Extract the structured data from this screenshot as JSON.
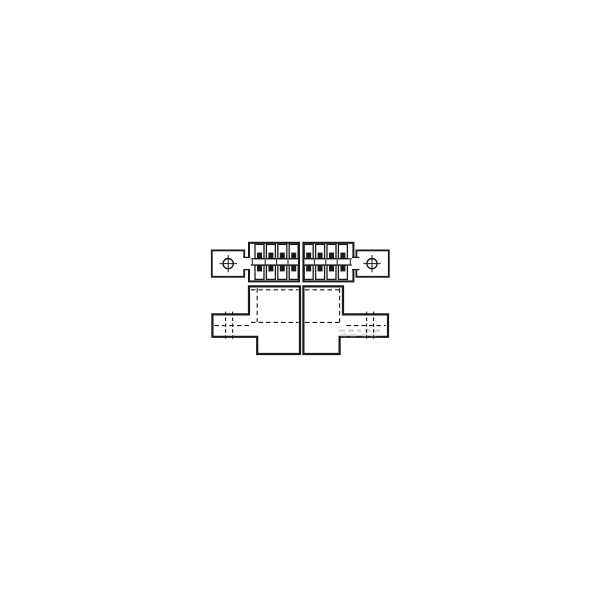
{
  "meta": {
    "app": "technical-drawing",
    "title": "Engineering line drawing of a two-piece electrical connector: top view with two staggered halves of dual-row contacts and mounting lugs with crosshair holes, front view of housing halves with side mounting tabs and dashed hidden lines",
    "background_color": "#ffffff",
    "line_color": "#1a1a1a",
    "fill_color": "#ffffff",
    "faint_mark_color": "#d8d8d8"
  },
  "views": {
    "top_view": {
      "label": "top-view",
      "halves": 2,
      "contact_rows_per_half": 2,
      "contact_columns_per_half": 4,
      "mounting_lugs": 2,
      "lug_hole_style": "circle-with-crosshair"
    },
    "front_view": {
      "label": "front-view",
      "halves": 2,
      "side_mounting_tabs": 2,
      "hidden_line_style": "dashed"
    }
  },
  "drawing": {
    "canvas": {
      "width": 600,
      "height": 600
    },
    "primitives": [
      {
        "name": "front-left-body-outline",
        "type": "path",
        "d": "M249,286.4 L300,286.4 L300,354 L257.2,354 L257.2,336.8 L212.4,336.8 L212.4,314.4 L249,314.4 Z",
        "sw": 2.2,
        "fill": "#ffffff"
      },
      {
        "name": "front-right-body-outline",
        "type": "path",
        "d": "M303.4,286.4 L343,286.4 L343,314.4 L388,314.4 L388,336.8 L339.6,336.8 L339.6,354 L303.4,354 Z",
        "sw": 2.2,
        "fill": "#ffffff"
      },
      {
        "name": "faint-watermark-mark-1",
        "type": "line",
        "x1": 339,
        "y1": 330.6,
        "x2": 361,
        "y2": 330.6,
        "sw": 2.6,
        "stroke": "#d8d8d8",
        "dash": "6 3"
      },
      {
        "name": "faint-watermark-mark-2",
        "type": "line",
        "x1": 365,
        "y1": 330.6,
        "x2": 381.6,
        "y2": 330.6,
        "sw": 2.6,
        "stroke": "#d8d8d8",
        "dash": "6 3"
      },
      {
        "name": "faint-watermark-mark-3",
        "type": "line",
        "x1": 341,
        "y1": 335,
        "x2": 357.6,
        "y2": 335,
        "sw": 2.6,
        "stroke": "#d8d8d8",
        "dash": "6 3"
      },
      {
        "name": "faint-watermark-mark-4",
        "type": "line",
        "x1": 361.6,
        "y1": 335,
        "x2": 379.6,
        "y2": 335,
        "sw": 2.6,
        "stroke": "#d8d8d8",
        "dash": "6 3"
      },
      {
        "name": "front-hidden-top-line-left",
        "type": "line",
        "x1": 251,
        "y1": 289.8,
        "x2": 298.4,
        "y2": 289.8,
        "sw": 1.1,
        "dash": "4.5 3"
      },
      {
        "name": "front-hidden-top-line-right",
        "type": "line",
        "x1": 305,
        "y1": 289.8,
        "x2": 341.4,
        "y2": 289.8,
        "sw": 1.1,
        "dash": "4.5 3"
      },
      {
        "name": "front-hidden-mid-line-left",
        "type": "line",
        "x1": 251,
        "y1": 322.4,
        "x2": 298.4,
        "y2": 322.4,
        "sw": 1.1,
        "dash": "4.5 3"
      },
      {
        "name": "front-hidden-mid-line-right",
        "type": "line",
        "x1": 305,
        "y1": 322.4,
        "x2": 341.4,
        "y2": 322.4,
        "sw": 1.1,
        "dash": "4.5 3"
      },
      {
        "name": "front-hidden-vertical-left",
        "type": "line",
        "x1": 257.2,
        "y1": 288.2,
        "x2": 257.2,
        "y2": 322,
        "sw": 1.1,
        "dash": "4.5 3"
      },
      {
        "name": "front-hidden-vertical-right",
        "type": "line",
        "x1": 339.6,
        "y1": 288.2,
        "x2": 339.6,
        "y2": 322,
        "sw": 1.1,
        "dash": "4.5 3"
      },
      {
        "name": "front-left-tab-hole-hidden-edge-1",
        "type": "line",
        "x1": 225.6,
        "y1": 311.6,
        "x2": 225.6,
        "y2": 340,
        "sw": 1.1,
        "dash": "3.5 2.4"
      },
      {
        "name": "front-left-tab-hole-hidden-edge-2",
        "type": "line",
        "x1": 232.6,
        "y1": 311.6,
        "x2": 232.6,
        "y2": 340,
        "sw": 1.1,
        "dash": "3.5 2.4"
      },
      {
        "name": "front-left-tab-centerline",
        "type": "line",
        "x1": 214.4,
        "y1": 325.6,
        "x2": 251.6,
        "y2": 325.6,
        "sw": 1.1,
        "dash": "4.5 3"
      },
      {
        "name": "front-right-tab-hole-hidden-edge-1",
        "type": "line",
        "x1": 366.6,
        "y1": 311.6,
        "x2": 366.6,
        "y2": 340,
        "sw": 1.1,
        "dash": "3.5 2.4"
      },
      {
        "name": "front-right-tab-hole-hidden-edge-2",
        "type": "line",
        "x1": 373.6,
        "y1": 311.6,
        "x2": 373.6,
        "y2": 340,
        "sw": 1.1,
        "dash": "3.5 2.4"
      },
      {
        "name": "front-right-tab-centerline",
        "type": "line",
        "x1": 346.4,
        "y1": 325.6,
        "x2": 385.6,
        "y2": 325.6,
        "sw": 1.1,
        "dash": "4.5 3"
      },
      {
        "name": "top-left-mounting-lug",
        "type": "rect",
        "x": 211.8,
        "y": 250.4,
        "w": 32.4,
        "h": 26.4,
        "sw": 1.8,
        "fill": "#ffffff"
      },
      {
        "name": "top-right-mounting-lug",
        "type": "rect",
        "x": 356.4,
        "y": 250.4,
        "w": 32.4,
        "h": 26.4,
        "sw": 1.8,
        "fill": "#ffffff"
      },
      {
        "name": "top-left-contact-block",
        "type": "rect",
        "x": 249,
        "y": 242.8,
        "w": 50,
        "h": 38.6,
        "sw": 2,
        "fill": "#ffffff"
      },
      {
        "name": "top-right-contact-block",
        "type": "rect",
        "x": 303.4,
        "y": 242.8,
        "w": 50,
        "h": 38.6,
        "sw": 2,
        "fill": "#ffffff"
      },
      {
        "name": "top-left-neck-fill",
        "type": "rect",
        "x": 243,
        "y": 258,
        "w": 7.6,
        "h": 11,
        "sw": 0,
        "stroke": "none",
        "fill": "#ffffff"
      },
      {
        "name": "top-left-neck-top-edge",
        "type": "line",
        "x1": 243.4,
        "y1": 257.4,
        "x2": 250.2,
        "y2": 257.4,
        "sw": 1.3
      },
      {
        "name": "top-left-neck-bottom-edge",
        "type": "line",
        "x1": 243.4,
        "y1": 269.6,
        "x2": 250.2,
        "y2": 269.6,
        "sw": 1.3
      },
      {
        "name": "top-right-neck-fill",
        "type": "rect",
        "x": 352.2,
        "y": 258,
        "w": 7.6,
        "h": 11,
        "sw": 0,
        "stroke": "none",
        "fill": "#ffffff"
      },
      {
        "name": "top-right-neck-top-edge",
        "type": "line",
        "x1": 352,
        "y1": 257.4,
        "x2": 359.4,
        "y2": 257.4,
        "sw": 1.3
      },
      {
        "name": "top-right-neck-bottom-edge",
        "type": "line",
        "x1": 352,
        "y1": 269.6,
        "x2": 359.4,
        "y2": 269.6,
        "sw": 1.3
      },
      {
        "name": "top-left-lug-hole",
        "type": "circle",
        "cx": 228.2,
        "cy": 263.6,
        "r": 5.1,
        "sw": 1.4,
        "fill": "#ffffff"
      },
      {
        "name": "top-left-lug-crosshair-h",
        "type": "line",
        "x1": 219.5,
        "y1": 263.6,
        "x2": 237,
        "y2": 263.6,
        "sw": 1
      },
      {
        "name": "top-left-lug-crosshair-v",
        "type": "line",
        "x1": 228.2,
        "y1": 255,
        "x2": 228.2,
        "y2": 272.2,
        "sw": 1
      },
      {
        "name": "top-right-lug-hole",
        "type": "circle",
        "cx": 372,
        "cy": 263.6,
        "r": 5.1,
        "sw": 1.4,
        "fill": "#ffffff"
      },
      {
        "name": "top-right-lug-crosshair-h",
        "type": "line",
        "x1": 363.3,
        "y1": 263.6,
        "x2": 380.7,
        "y2": 263.6,
        "sw": 1
      },
      {
        "name": "top-right-lug-crosshair-v",
        "type": "line",
        "x1": 372,
        "y1": 255,
        "x2": 372,
        "y2": 272.2,
        "sw": 1
      },
      {
        "name": "top-left-mating-channel-upper",
        "type": "line",
        "x1": 250.6,
        "y1": 258.8,
        "x2": 297.6,
        "y2": 258.8,
        "sw": 1.2
      },
      {
        "name": "top-left-mating-channel-lower",
        "type": "line",
        "x1": 250.6,
        "y1": 265,
        "x2": 297.6,
        "y2": 265,
        "sw": 1.2
      },
      {
        "name": "top-right-mating-channel-upper",
        "type": "line",
        "x1": 304.8,
        "y1": 258.8,
        "x2": 351.8,
        "y2": 258.8,
        "sw": 1.2
      },
      {
        "name": "top-right-mating-channel-lower",
        "type": "line",
        "x1": 304.8,
        "y1": 265,
        "x2": 351.8,
        "y2": 265,
        "sw": 1.2
      },
      {
        "name": "contact-cavity",
        "type": "rect",
        "x": 255,
        "y": 244.4,
        "w": 9,
        "h": 14.2,
        "sw": 1.3,
        "fill": "#ffffff"
      },
      {
        "name": "contact-cavity",
        "type": "rect",
        "x": 266.4,
        "y": 244.4,
        "w": 9,
        "h": 14.2,
        "sw": 1.3,
        "fill": "#ffffff"
      },
      {
        "name": "contact-cavity",
        "type": "rect",
        "x": 277.8,
        "y": 244.4,
        "w": 9,
        "h": 14.2,
        "sw": 1.3,
        "fill": "#ffffff"
      },
      {
        "name": "contact-cavity",
        "type": "rect",
        "x": 289.2,
        "y": 244.4,
        "w": 9,
        "h": 14.2,
        "sw": 1.3,
        "fill": "#ffffff"
      },
      {
        "name": "contact-cavity",
        "type": "rect",
        "x": 255,
        "y": 265.2,
        "w": 9,
        "h": 14.2,
        "sw": 1.3,
        "fill": "#ffffff"
      },
      {
        "name": "contact-cavity",
        "type": "rect",
        "x": 266.4,
        "y": 265.2,
        "w": 9,
        "h": 14.2,
        "sw": 1.3,
        "fill": "#ffffff"
      },
      {
        "name": "contact-cavity",
        "type": "rect",
        "x": 277.8,
        "y": 265.2,
        "w": 9,
        "h": 14.2,
        "sw": 1.3,
        "fill": "#ffffff"
      },
      {
        "name": "contact-cavity",
        "type": "rect",
        "x": 289.2,
        "y": 265.2,
        "w": 9,
        "h": 14.2,
        "sw": 1.3,
        "fill": "#ffffff"
      },
      {
        "name": "contact-cavity",
        "type": "rect",
        "x": 304.2,
        "y": 244.4,
        "w": 9,
        "h": 14.2,
        "sw": 1.3,
        "fill": "#ffffff"
      },
      {
        "name": "contact-cavity",
        "type": "rect",
        "x": 315.6,
        "y": 244.4,
        "w": 9,
        "h": 14.2,
        "sw": 1.3,
        "fill": "#ffffff"
      },
      {
        "name": "contact-cavity",
        "type": "rect",
        "x": 327,
        "y": 244.4,
        "w": 9,
        "h": 14.2,
        "sw": 1.3,
        "fill": "#ffffff"
      },
      {
        "name": "contact-cavity",
        "type": "rect",
        "x": 338.4,
        "y": 244.4,
        "w": 9,
        "h": 14.2,
        "sw": 1.3,
        "fill": "#ffffff"
      },
      {
        "name": "contact-cavity",
        "type": "rect",
        "x": 304.2,
        "y": 265.2,
        "w": 9,
        "h": 14.2,
        "sw": 1.3,
        "fill": "#ffffff"
      },
      {
        "name": "contact-cavity",
        "type": "rect",
        "x": 315.6,
        "y": 265.2,
        "w": 9,
        "h": 14.2,
        "sw": 1.3,
        "fill": "#ffffff"
      },
      {
        "name": "contact-cavity",
        "type": "rect",
        "x": 327,
        "y": 265.2,
        "w": 9,
        "h": 14.2,
        "sw": 1.3,
        "fill": "#ffffff"
      },
      {
        "name": "contact-cavity",
        "type": "rect",
        "x": 338.4,
        "y": 265.2,
        "w": 9,
        "h": 14.2,
        "sw": 1.3,
        "fill": "#ffffff"
      },
      {
        "name": "contact-pin",
        "type": "rect",
        "x": 257,
        "y": 252.6,
        "w": 5,
        "h": 6.2,
        "sw": 0,
        "stroke": "none",
        "fill": "#1a1a1a"
      },
      {
        "name": "contact-pin",
        "type": "rect",
        "x": 268.4,
        "y": 252.6,
        "w": 5,
        "h": 6.2,
        "sw": 0,
        "stroke": "none",
        "fill": "#1a1a1a"
      },
      {
        "name": "contact-pin",
        "type": "rect",
        "x": 279.8,
        "y": 252.6,
        "w": 5,
        "h": 6.2,
        "sw": 0,
        "stroke": "none",
        "fill": "#1a1a1a"
      },
      {
        "name": "contact-pin",
        "type": "rect",
        "x": 291.2,
        "y": 252.6,
        "w": 5,
        "h": 6.2,
        "sw": 0,
        "stroke": "none",
        "fill": "#1a1a1a"
      },
      {
        "name": "contact-pin",
        "type": "rect",
        "x": 257,
        "y": 265.2,
        "w": 5,
        "h": 6.2,
        "sw": 0,
        "stroke": "none",
        "fill": "#1a1a1a"
      },
      {
        "name": "contact-pin",
        "type": "rect",
        "x": 268.4,
        "y": 265.2,
        "w": 5,
        "h": 6.2,
        "sw": 0,
        "stroke": "none",
        "fill": "#1a1a1a"
      },
      {
        "name": "contact-pin",
        "type": "rect",
        "x": 279.8,
        "y": 265.2,
        "w": 5,
        "h": 6.2,
        "sw": 0,
        "stroke": "none",
        "fill": "#1a1a1a"
      },
      {
        "name": "contact-pin",
        "type": "rect",
        "x": 291.2,
        "y": 265.2,
        "w": 5,
        "h": 6.2,
        "sw": 0,
        "stroke": "none",
        "fill": "#1a1a1a"
      },
      {
        "name": "contact-pin",
        "type": "rect",
        "x": 306.2,
        "y": 252.6,
        "w": 5,
        "h": 6.2,
        "sw": 0,
        "stroke": "none",
        "fill": "#1a1a1a"
      },
      {
        "name": "contact-pin",
        "type": "rect",
        "x": 317.6,
        "y": 252.6,
        "w": 5,
        "h": 6.2,
        "sw": 0,
        "stroke": "none",
        "fill": "#1a1a1a"
      },
      {
        "name": "contact-pin",
        "type": "rect",
        "x": 329,
        "y": 252.6,
        "w": 5,
        "h": 6.2,
        "sw": 0,
        "stroke": "none",
        "fill": "#1a1a1a"
      },
      {
        "name": "contact-pin",
        "type": "rect",
        "x": 340.4,
        "y": 252.6,
        "w": 5,
        "h": 6.2,
        "sw": 0,
        "stroke": "none",
        "fill": "#1a1a1a"
      },
      {
        "name": "contact-pin",
        "type": "rect",
        "x": 306.2,
        "y": 265.2,
        "w": 5,
        "h": 6.2,
        "sw": 0,
        "stroke": "none",
        "fill": "#1a1a1a"
      },
      {
        "name": "contact-pin",
        "type": "rect",
        "x": 317.6,
        "y": 265.2,
        "w": 5,
        "h": 6.2,
        "sw": 0,
        "stroke": "none",
        "fill": "#1a1a1a"
      },
      {
        "name": "contact-pin",
        "type": "rect",
        "x": 329,
        "y": 265.2,
        "w": 5,
        "h": 6.2,
        "sw": 0,
        "stroke": "none",
        "fill": "#1a1a1a"
      },
      {
        "name": "contact-pin",
        "type": "rect",
        "x": 340.4,
        "y": 265.2,
        "w": 5,
        "h": 6.2,
        "sw": 0,
        "stroke": "none",
        "fill": "#1a1a1a"
      },
      {
        "name": "channel-tick",
        "type": "line",
        "x1": 252.3,
        "y1": 259.6,
        "x2": 252.3,
        "y2": 264.4,
        "sw": 1
      },
      {
        "name": "channel-tick",
        "type": "line",
        "x1": 265.2,
        "y1": 259.6,
        "x2": 265.2,
        "y2": 264.4,
        "sw": 1
      },
      {
        "name": "channel-tick",
        "type": "line",
        "x1": 276.6,
        "y1": 259.6,
        "x2": 276.6,
        "y2": 264.4,
        "sw": 1
      },
      {
        "name": "channel-tick",
        "type": "line",
        "x1": 288,
        "y1": 259.6,
        "x2": 288,
        "y2": 264.4,
        "sw": 1
      },
      {
        "name": "channel-tick",
        "type": "line",
        "x1": 314.4,
        "y1": 259.6,
        "x2": 314.4,
        "y2": 264.4,
        "sw": 1
      },
      {
        "name": "channel-tick",
        "type": "line",
        "x1": 325.8,
        "y1": 259.6,
        "x2": 325.8,
        "y2": 264.4,
        "sw": 1
      },
      {
        "name": "channel-tick",
        "type": "line",
        "x1": 337.2,
        "y1": 259.6,
        "x2": 337.2,
        "y2": 264.4,
        "sw": 1
      },
      {
        "name": "channel-tick",
        "type": "line",
        "x1": 350.3,
        "y1": 259.6,
        "x2": 350.3,
        "y2": 264.4,
        "sw": 1
      }
    ]
  }
}
